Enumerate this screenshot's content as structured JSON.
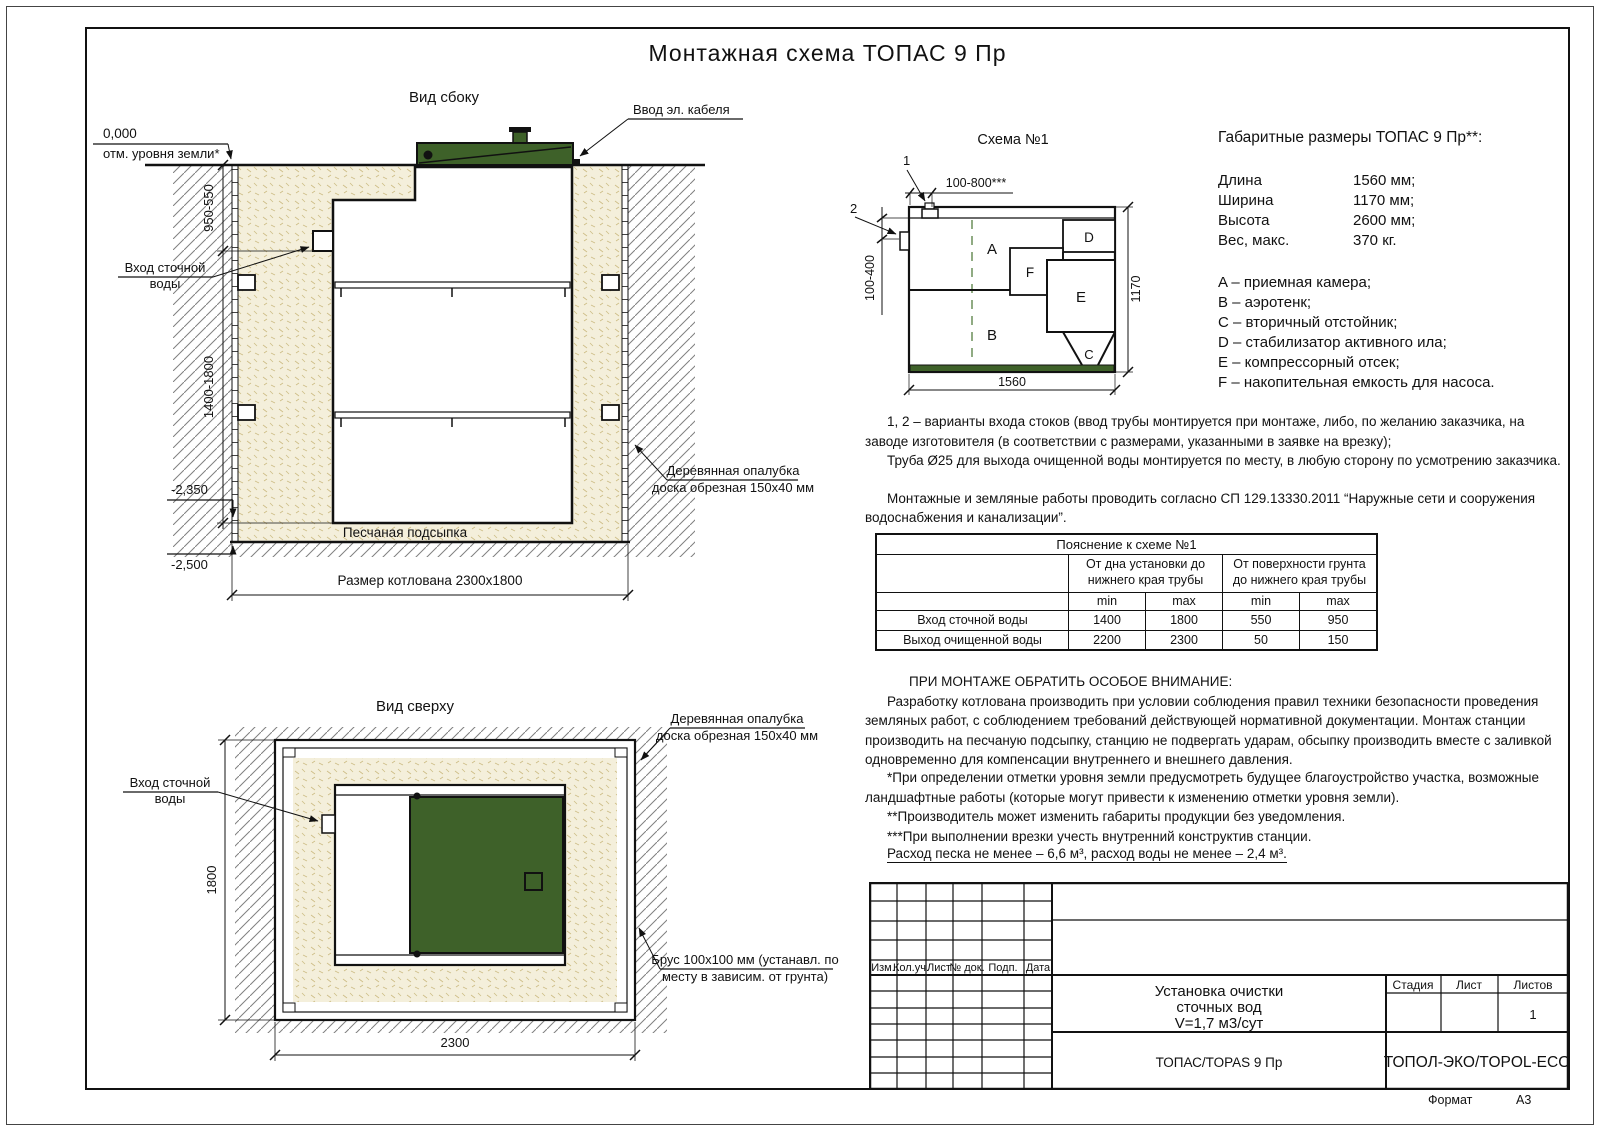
{
  "page": {
    "title": "Монтажная схема ТОПАС 9 Пр",
    "format_label": "Формат",
    "format_value": "А3"
  },
  "side_view": {
    "label": "Вид сбоку",
    "cable_entry": "Ввод эл. кабеля",
    "level_zero": "0,000",
    "ground_mark": "отм. уровня земли*",
    "dim_depth_top": "950-550",
    "dim_depth_main": "1400-1800",
    "inlet_line1": "Вход сточной",
    "inlet_line2": "воды",
    "level_minus_2350": "-2,350",
    "level_minus_2500": "-2,500",
    "sand_bed": "Песчаная подсыпка",
    "pit_size": "Размер котлована 2300x1800",
    "formwork_line1": "Деревянная опалубка",
    "formwork_line2": "доска обрезная 150x40 мм"
  },
  "top_view": {
    "label": "Вид сверху",
    "inlet_line1": "Вход сточной",
    "inlet_line2": "воды",
    "dim_width": "1800",
    "dim_length": "2300",
    "formwork_line1": "Деревянная опалубка",
    "formwork_line2": "доска обрезная 150x40 мм",
    "timber_line1": "Брус 100x100 мм (устанавл. по",
    "timber_line2": "месту в зависим. от грунта)"
  },
  "schema": {
    "title": "Схема №1",
    "marker1": "1",
    "marker2": "2",
    "dim_inlet_offset": "100-800***",
    "dim_inlet_depth": "100-400",
    "dim_height": "1170",
    "dim_length": "1560",
    "comp_a": "A",
    "comp_b": "B",
    "comp_c": "C",
    "comp_d": "D",
    "comp_e": "E",
    "comp_f": "F"
  },
  "specs": {
    "title": "Габаритные размеры ТОПАС 9 Пр**:",
    "rows": [
      {
        "label": "Длина",
        "value": "1560 мм;"
      },
      {
        "label": "Ширина",
        "value": "1170 мм;"
      },
      {
        "label": "Высота",
        "value": "2600 мм;"
      },
      {
        "label": "Вес, макс.",
        "value": "370 кг."
      }
    ],
    "legend": [
      "A – приемная камера;",
      "B – аэротенк;",
      "C – вторичный отстойник;",
      "D – стабилизатор активного ила;",
      "E – компрессорный отсек;",
      "F – накопительная емкость для насоса."
    ]
  },
  "notes": {
    "p1": "1, 2 – варианты входа  стоков (ввод трубы монтируется при монтаже, либо, по желанию заказчика, на заводе изготовителя (в соответствии с размерами, указанными в заявке на врезку);",
    "p2": "Труба Ø25 для выхода очищенной воды монтируется по месту, в любую сторону по усмотрению заказчика.",
    "p3": "Монтажные и земляные работы проводить согласно СП 129.13330.2011 “Наружные сети и сооружения водоснабжения и канализации”."
  },
  "table": {
    "title": "Пояснение к схеме №1",
    "group1": "От дна установки до нижнего края трубы",
    "group2": "От поверхности грунта до нижнего края трубы",
    "min": "min",
    "max": "max",
    "rows": [
      {
        "name": "Вход сточной воды",
        "v1": "1400",
        "v2": "1800",
        "v3": "550",
        "v4": "950"
      },
      {
        "name": "Выход очищенной воды",
        "v1": "2200",
        "v2": "2300",
        "v3": "50",
        "v4": "150"
      }
    ]
  },
  "warning": {
    "heading": "ПРИ МОНТАЖЕ ОБРАТИТЬ ОСОБОЕ ВНИМАНИЕ:",
    "body": "Разработку котлована производить при условии соблюдения правил техники безопасности проведения земляных работ, с соблюдением требований действующей нормативной документации. Монтаж станции производить на песчаную подсыпку, станцию не подвергать ударам, обсыпку производить вместе с заливкой одновременно для компенсации внутреннего и внешнего давления.",
    "footnote1": "*При определении отметки уровня земли предусмотреть будущее благоустройство участка, возможные ландшафтные работы (которые могут привести к изменению отметки уровня земли).",
    "footnote2": "**Производитель может изменить габариты продукции без уведомления.",
    "footnote3": "***При выполнении врезки учесть внутренний конструктив станции.",
    "consumption": "Расход песка не менее – 6,6 м³, расход воды не менее – 2,4 м³."
  },
  "title_block": {
    "col1": "Изм.",
    "col2": "Кол.уч.",
    "col3": "Лист",
    "col4": "№ док.",
    "col5": "Подп.",
    "col6": "Дата",
    "name1": "Установка очистки",
    "name2": "сточных вод",
    "name3": "V=1,7 м3/сут",
    "product": "ТОПАС/TOPAS 9 Пр",
    "company": "ТОПОЛ-ЭКО/TOPOL-ECO",
    "stage": "Стадия",
    "sheet": "Лист",
    "sheets": "Листов",
    "sheets_value": "1"
  },
  "colors": {
    "lid_green": "#3e6129",
    "sand_fill": "#f4efdb",
    "hatch_line": "#808080"
  }
}
